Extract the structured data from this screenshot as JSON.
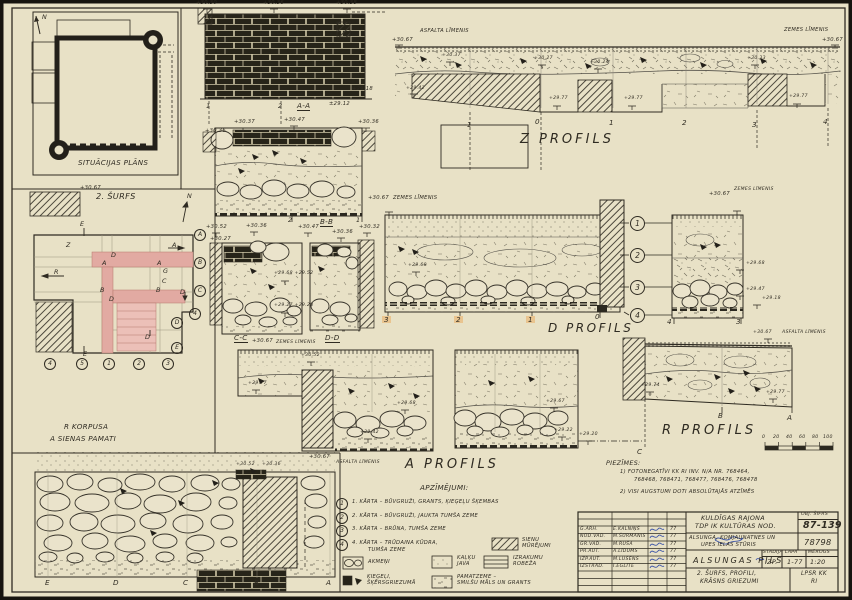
{
  "situ": {
    "title": "SITUĀCIJAS PLĀNS",
    "north": "N"
  },
  "surfs": {
    "title": "2. ŠURFS",
    "elev": "+30.67",
    "north": "N",
    "marks": [
      "E",
      "Z",
      "R",
      "D",
      "A",
      "A",
      "A",
      "G",
      "C",
      "B",
      "B",
      "D",
      "D",
      "D",
      "E"
    ],
    "rcirc": [
      "A",
      "B",
      "C",
      "4",
      "D",
      "E"
    ],
    "bcirc": [
      "4",
      "5",
      "1",
      "2",
      "3"
    ]
  },
  "rk": {
    "l1": "R KORPUSA",
    "l2": "A SIENAS PAMATI",
    "letters": [
      "E",
      "D",
      "C",
      "B",
      "A"
    ]
  },
  "aa": {
    "title": "A-A",
    "e": [
      "+30.30",
      "+30.36",
      "+30.38",
      "+29.18",
      "±29.12"
    ],
    "ax": [
      "1",
      "2"
    ]
  },
  "bb": {
    "title": "B-B",
    "e": [
      "+30.36",
      "+30.37",
      "+30.47",
      "+30.36"
    ],
    "ax": [
      "2",
      "1"
    ]
  },
  "cc": {
    "title": "C-C",
    "e": [
      "+30.52",
      "+30.36",
      "+30.27"
    ],
    "foot": "+30.67",
    "footlbl": "ZEMES LĪMENIS"
  },
  "dd": {
    "title": "D-D",
    "e": [
      "+30.47",
      "+30.36",
      "+30.32"
    ]
  },
  "mid": {
    "top": "+29.68  +29.52",
    "bot": "+29.27  +29.28"
  },
  "zp": {
    "title": "Z PROFILS",
    "le": "+30.67",
    "ll": "ASFALTA LĪMENIS",
    "rl": "ZEMES LĪMENIS",
    "re": "+30.67",
    "e": [
      "+30.37",
      "+30.27",
      "+30.24",
      "+30.33",
      "+29.42",
      "+29.77",
      "+29.77",
      "+29.77"
    ],
    "ax": [
      "-1",
      "0",
      "1",
      "2",
      "3",
      "4"
    ]
  },
  "dp": {
    "title": "D PROFILS",
    "te": "+30.67",
    "tl": "ZEMES LĪMENIS",
    "e": "+29.68",
    "ax": [
      "3",
      "2",
      "1",
      "0"
    ],
    "ly": [
      "1",
      "2",
      "3",
      "4"
    ]
  },
  "cp": {
    "te": "+30.67",
    "tl": "ZEMES LĪMENIS",
    "e": [
      "+29.68",
      "+29.47",
      "+29.18"
    ],
    "ax": [
      "4",
      "3"
    ]
  },
  "rp": {
    "title": "R PROFILS",
    "te": "+30.67",
    "tl": "ASFALTA LĪMENIS",
    "el": "+29.74",
    "er": "+29.77",
    "pts": [
      "B",
      "A",
      "C"
    ],
    "scale": [
      "0",
      "20",
      "40",
      "60",
      "80",
      "100"
    ]
  },
  "ap": {
    "title": "A PROFILS",
    "e": [
      "+30.52",
      "+29.77",
      "+29.68",
      "+29.42",
      "+29.67",
      "+29.22",
      "+29.20"
    ],
    "fe": "+30.67",
    "fl": "ASFALTA LĪMENIS",
    "x1": "+30.52",
    "x2": "+30.36"
  },
  "pz": {
    "t": "PIEZĪMES:",
    "a": "1) FOTONEGATĪVI KK RI INV. N/A NR. 768464,",
    "b": "768468, 768471, 768477, 768476, 768478",
    "c": "2) VISI AUGSTUMI DOTI ABSOLŪTAJĀS ATZĪMĒS"
  },
  "lg": {
    "title": "APZĪMĒJUMI:",
    "n": [
      "1",
      "2",
      "3",
      "4"
    ],
    "i1": "1. KĀRTA – BŪVGRUŽI, GRANTS, ĶIEĢEĻU ŠĶEMBAS",
    "i2": "2. KĀRTA – BŪVGRUŽI, JAUKTA TUMŠA ZEME",
    "i3": "3. KĀRTA – BRŪNA, TUMŠA ZEME",
    "i4": "4. KĀRTA – TRŪDAINA KŪDRA,",
    "i4b": "TUMŠA ZEME",
    "akmeni": "AKMEŅI",
    "kieg1": "ĶIEĢEĻI,",
    "kieg2": "ŠĶĒRSGRIEZUMĀ",
    "kalku1": "KAĻĶU",
    "kalku2": "JAVA",
    "pam1": "PAMATZEME –",
    "pam2": "SMILŠU MĀLS UN GRANTS",
    "sienu1": "SIENU",
    "sienu2": "MŪRĒJUMI",
    "izr1": "IZRAKUMU",
    "izr2": "ROBEŽA"
  },
  "tb": {
    "org1": "KULDĪGAS RAJONA",
    "org2": "TDP IK KULTŪRAS NOD.",
    "shl": "OBJ. ŠIFRS",
    "sh": "87-139",
    "ad1": "ALSUNGA, KOMJAUNATNES UN",
    "ad2": "UPES IELAS STŪRIS",
    "adn": "78798",
    "obj": "ALSUNGAS PILS",
    "stl": "STADIJA",
    "st": "IZP.",
    "lpl": "LAPA",
    "lp": "1-77",
    "mgl": "MĒROGS",
    "mg": "1:20",
    "sh1": "2. ŠURFS, PROFILI,",
    "sh2": "KRĀSNS GRIEZUMI",
    "a1": "LPSR KK",
    "a2": "RI",
    "rows": [
      {
        "r": "G.ARH.",
        "n": "E.KALNIŅŠ",
        "d": "77"
      },
      {
        "r": "NOD.VAD.",
        "n": "M.ŠŪRMANIS",
        "d": "77"
      },
      {
        "r": "GR.VAD.",
        "n": "M.RUŠA",
        "d": "77"
      },
      {
        "r": "PR.AUT.",
        "n": "A.LĪDUMS",
        "d": "77"
      },
      {
        "r": "IZP.AUT.",
        "n": "M.LŪSĒNS",
        "d": "77"
      },
      {
        "r": "IZSTRĀD.",
        "n": "I.EGLĪTE",
        "d": "77"
      }
    ]
  }
}
